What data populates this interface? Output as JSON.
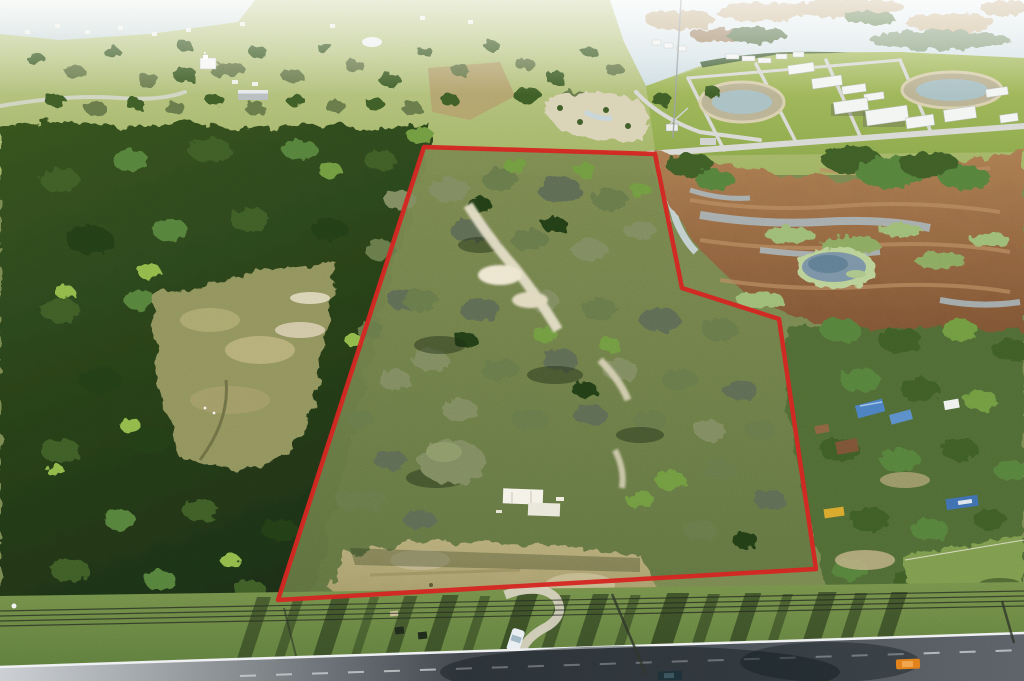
{
  "meta": {
    "kind": "aerial-drone-photograph",
    "subject": "wooded-land-parcel-with-red-boundary-outline",
    "width_px": 1024,
    "height_px": 681
  },
  "boundary": {
    "points": "424,147 655,154 682,288 779,319 816,569 278,600",
    "width": "4.5",
    "closed": true
  },
  "palette": {
    "boundary-red": "#d22420",
    "forest-dark": "#1b2d12",
    "forest-mid": "#35521f",
    "canopy-olive": "#66784a",
    "canopy-sage": "#7e8a5e",
    "canopy-bright": "#6f9a3f",
    "field-light": "#c6d095",
    "lawn-green": "#9cb254",
    "lake-pale": "#e4eef0",
    "marsh-brown": "#9a6a44",
    "water-channel": "#a9bcc6",
    "pond-blue": "#7891a4",
    "sand-light": "#e3dcc4",
    "sand-mid": "#b5aa78",
    "slab-white": "#f4f2e8",
    "building-white": "#f3f5f3",
    "verge-green": "#6d8747",
    "shadow-dark": "#1c2a14",
    "road-light": "#caced2",
    "road-dark": "#41464d",
    "stripe-white": "#eef0f2",
    "tarp-blue": "#4a7ec0",
    "car-orange": "#e07d1a",
    "car-white": "#e8eef2",
    "car-dark": "#1d3038"
  },
  "scene": {
    "regions": [
      "distant-lake",
      "facility-campus",
      "farm-fields",
      "pine-forest",
      "pasture-clearing",
      "property-woodland",
      "sand-clearing",
      "concrete-slab",
      "wetland-creek",
      "marsh",
      "marsh-pond",
      "residential-trees",
      "southeast-pasture",
      "grass-verge",
      "highway",
      "power-lines",
      "radio-tower",
      "property-boundary"
    ]
  }
}
